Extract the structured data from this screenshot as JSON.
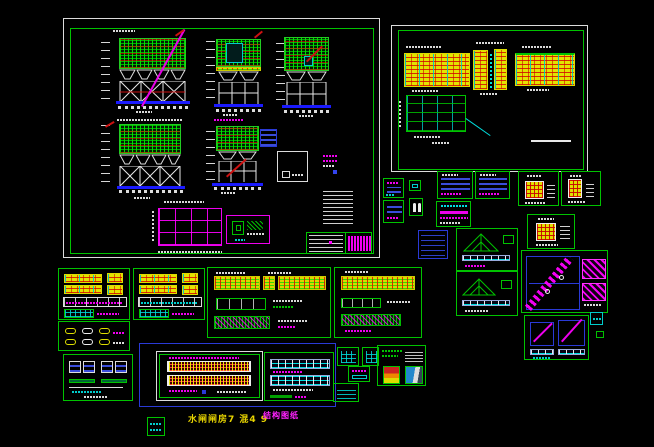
{
  "window": {
    "type": "cad-model-space-screenshot",
    "background": "#000000",
    "description": "AutoCAD-style black model space holding a collage of structural drawing sheets and detail panels for a hoppered steel bunker / gate-house structure"
  },
  "palette": {
    "sheet_frame_green": "#00c200",
    "sheet_frame_white": "#dcdcdc",
    "panel_frame_blue": "#2a3ad6",
    "hatch_green": "#00dd00",
    "hatch_yellow": "#e3e300",
    "accent_red": "#cc1111",
    "accent_cyan": "#00cccc",
    "accent_magenta": "#ff00ff",
    "base_blue": "#1a1aff",
    "line_white": "#e0e0e0",
    "label_yellow": "#e8d400"
  },
  "labels": {
    "sheet_title": "水闸闸房7 混4 9",
    "sheet_note": "结构图纸"
  },
  "sheets": [
    {
      "id": "sheet-a",
      "desc": "Main sheet: three front/side elevations and two rear elevations of hoppered bunker on X-braced steel frame, plan grid, connection details, notes column, title block"
    },
    {
      "id": "sheet-b",
      "desc": "Beam sheet: three yellow-hatched beam elevations and a framing plan grid"
    },
    {
      "id": "panel-detail-1",
      "desc": "small detail with magenta/blue connection sketch"
    },
    {
      "id": "panel-detail-2",
      "desc": "tiny cyan detail box"
    },
    {
      "id": "panel-detail-3",
      "desc": "blue reinforcement rows detail"
    },
    {
      "id": "panel-detail-4",
      "desc": "white double-page symbol detail"
    },
    {
      "id": "panel-rebar-1",
      "desc": "dense blue rebar schedule"
    },
    {
      "id": "panel-rebar-2",
      "desc": "dense blue rebar schedule"
    },
    {
      "id": "panel-magenta-table",
      "desc": "magenta bar schedule with cyan ring row"
    },
    {
      "id": "panel-colgrid-1",
      "desc": "column section with yellow/red tie grid"
    },
    {
      "id": "panel-colgrid-2",
      "desc": "column section with yellow/red tie grid"
    },
    {
      "id": "panel-colgrid-3",
      "desc": "column section with yellow/red tie grid"
    },
    {
      "id": "panel-blue-table",
      "desc": "blue-bordered schedule table"
    },
    {
      "id": "panel-truss-1",
      "desc": "green hatched roof truss with cyan purlin strip"
    },
    {
      "id": "panel-truss-2",
      "desc": "green hatched roof truss with cyan purlin strip"
    },
    {
      "id": "panel-stair-big",
      "desc": "stair flight detail, magenta diagonal in blue frame, magenta landing details"
    },
    {
      "id": "panel-stair-small",
      "desc": "two stair section details with hatched bases"
    },
    {
      "id": "panel-cyan-stamp",
      "desc": "small cyan-bordered mark"
    },
    {
      "id": "panel-beams-left-1",
      "desc": "yellow beam elevations with white schedule and green grid"
    },
    {
      "id": "panel-beams-left-2",
      "desc": "yellow beam elevations with white schedule and green grid"
    },
    {
      "id": "panel-weld-ovals",
      "desc": "weld/bolt oval details"
    },
    {
      "id": "panel-sections",
      "desc": "member section squares with green bars"
    },
    {
      "id": "panel-beams-wide",
      "desc": "wide panel: yellow/green hatched beams, green table, magenta-hatched strip"
    },
    {
      "id": "panel-beams-right",
      "desc": "yellow/green hatched beams with table and strip"
    },
    {
      "id": "sheet-c",
      "desc": "blue-framed bottom sheet: red/yellow hatched beam elevations (left) and cyan truss elevations (right)"
    },
    {
      "id": "panel-legend-grid-1",
      "desc": "small cyan grid legend"
    },
    {
      "id": "panel-legend-grid-2",
      "desc": "small cyan grid legend"
    },
    {
      "id": "panel-legend-note",
      "desc": "magenta note with cyan bar"
    },
    {
      "id": "panel-legend-table",
      "desc": "cyan lined mini table"
    },
    {
      "id": "panel-images",
      "desc": "two small rendered preview images with green captions"
    },
    {
      "id": "panel-stamp",
      "desc": "small green stamp box with cyan glyphs"
    }
  ]
}
